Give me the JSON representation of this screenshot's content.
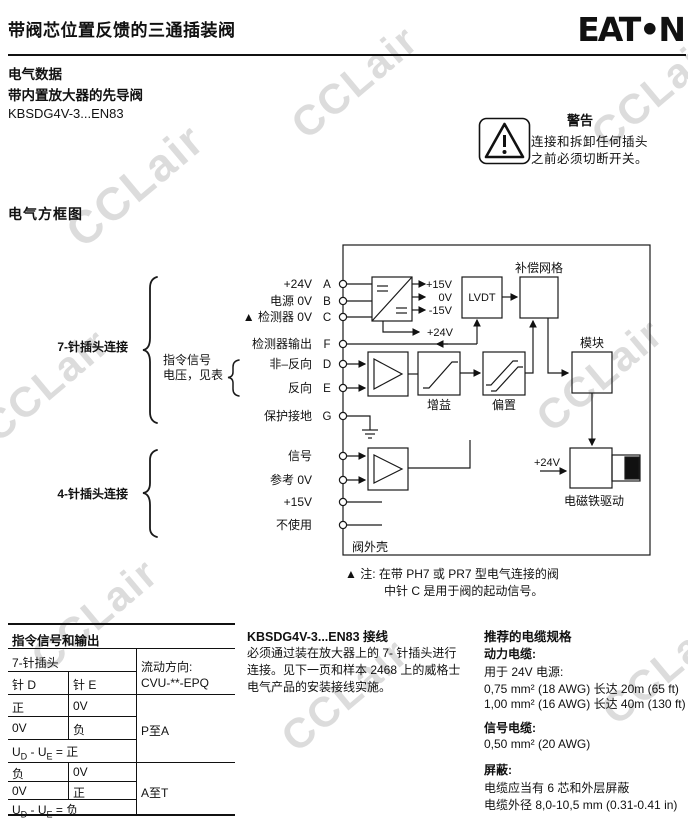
{
  "watermark": {
    "text": "CCLair"
  },
  "header": {
    "title": "带阀芯位置反馈的三通插装阀",
    "logo": "EAT•N"
  },
  "intro": {
    "line1": "电气数据",
    "line2": "带内置放大器的先导阀",
    "line3": "KBSDG4V-3...EN83"
  },
  "warning": {
    "title": "警告",
    "line1": "连接和拆卸任何插头",
    "line2": "之前必须切断开关。"
  },
  "section": {
    "title": "电气方框图"
  },
  "diagram": {
    "connector7": "7-针插头连接",
    "connector4": "4-针插头连接",
    "cmd1": "指令信号",
    "cmd2": "电压，见表",
    "pins7": [
      {
        "label": "+24V",
        "letter": "A"
      },
      {
        "label": "电源 0V",
        "letter": "B"
      },
      {
        "label": "▲ 检测器 0V",
        "letter": "C"
      },
      {
        "label": "检测器输出",
        "letter": "F"
      },
      {
        "label": "非–反向",
        "letter": "D"
      },
      {
        "label": "反向",
        "letter": "E"
      },
      {
        "label": "保护接地",
        "letter": "G"
      }
    ],
    "pins4": [
      {
        "label": "信号"
      },
      {
        "label": "参考 0V"
      },
      {
        "label": "+15V"
      },
      {
        "label": "不使用"
      }
    ],
    "supply": {
      "out1": "+15V",
      "out2": "0V",
      "out3": "-15V",
      "out4": "+24V"
    },
    "lvdt": "LVDT",
    "comp": "补偿网格",
    "gain": "增益",
    "bias": "偏置",
    "module": "模块",
    "sol_supply": "+24V",
    "solenoid": "电磁铁驱动",
    "housing": "阀外壳",
    "note1": "▲ 注: 在带 PH7 或 PR7 型电气连接的阀",
    "note2": "中针 C 是用于阀的起动信号。"
  },
  "table": {
    "title": "指令信号和输出",
    "subtitle": "7-针插头",
    "col_d": "针 D",
    "col_e": "针 E",
    "flow_label": "流动方向:",
    "flow_model": "CVU-**-EPQ",
    "r1d": "正",
    "r1e": "0V",
    "r2d": "0V",
    "r2e": "负",
    "flow1": "P至A",
    "r4d": "负",
    "r4e": "0V",
    "r5d": "0V",
    "r5e": "正",
    "flow2": "A至T",
    "u": {
      "u1": "U",
      "s1": "D",
      "u2": " - U",
      "s2": "E",
      "pos": " = 正",
      "neg": " = 负"
    }
  },
  "wiring": {
    "title": "KBSDG4V-3...EN83 接线",
    "body": "必须通过装在放大器上的 7- 针插头进行连接。见下一页和样本 2468 上的威格士电气产品的安装接线实施。"
  },
  "cable": {
    "title": "推荐的电缆规格",
    "power_title": "动力电缆:",
    "power_sub": "用于 24V 电源:",
    "power_l1": "0,75 mm² (18 AWG) 长达 20m (65 ft)",
    "power_l2": "1,00 mm² (16 AWG) 长达 40m (130 ft)",
    "signal_title": "信号电缆:",
    "signal_l1": "0,50 mm² (20 AWG)",
    "shield_title": "屏蔽:",
    "shield_l1": "电缆应当有 6 芯和外层屏蔽",
    "shield_l2": "电缆外径 8,0-10,5 mm (0.31-0.41 in)"
  }
}
